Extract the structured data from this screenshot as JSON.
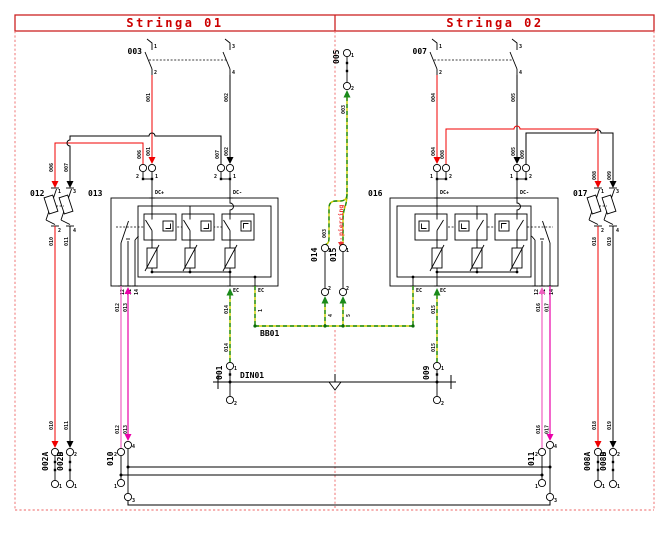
{
  "header": {
    "left": "Stringa 01",
    "right": "Stringa 02"
  },
  "components": {
    "k001": "001",
    "k002a": "002A",
    "k002b": "002B",
    "k003": "003",
    "k005": "005",
    "k007": "007",
    "k008a": "008A",
    "k008b": "008B",
    "k009": "009",
    "k010": "010",
    "k011": "011",
    "k012": "012",
    "k013": "013",
    "k014": "014",
    "k015": "015",
    "k016": "016",
    "k017": "017"
  },
  "wires": {
    "w001": "001",
    "w002": "002",
    "w003": "003",
    "w004": "004",
    "w005": "005",
    "w006": "006",
    "w007": "007",
    "w008": "008",
    "w009": "009",
    "w010": "010",
    "w011": "011",
    "w012": "012",
    "w013": "013",
    "w014": "014",
    "w015": "015",
    "w016": "016",
    "w017": "017",
    "w018": "018",
    "w019": "019"
  },
  "terminals": {
    "t1": "1",
    "t2": "2",
    "t3": "3",
    "t4": "4",
    "t11": "11",
    "t12": "12",
    "t14": "14",
    "dc_plus": "DC+",
    "dc_minus": "DC-",
    "ec": "EC"
  },
  "bus": {
    "name": "BB01",
    "tap1": "1",
    "tap4": "4",
    "tap5": "5",
    "tap8": "8"
  },
  "din_rail": {
    "name": "DIN01"
  },
  "annotations": {
    "piercing": "piercing"
  },
  "colors": {
    "wire_red": "#f00000",
    "wire_black": "#000000",
    "wire_pink": "#f060c0",
    "wire_magenta": "#ea00a8",
    "pe_green": "#1a8a1a",
    "pe_yellow": "#cccc00",
    "frame_red": "#cc2222",
    "dashed_red": "#ee6666",
    "annotation_red": "#ee3333"
  }
}
